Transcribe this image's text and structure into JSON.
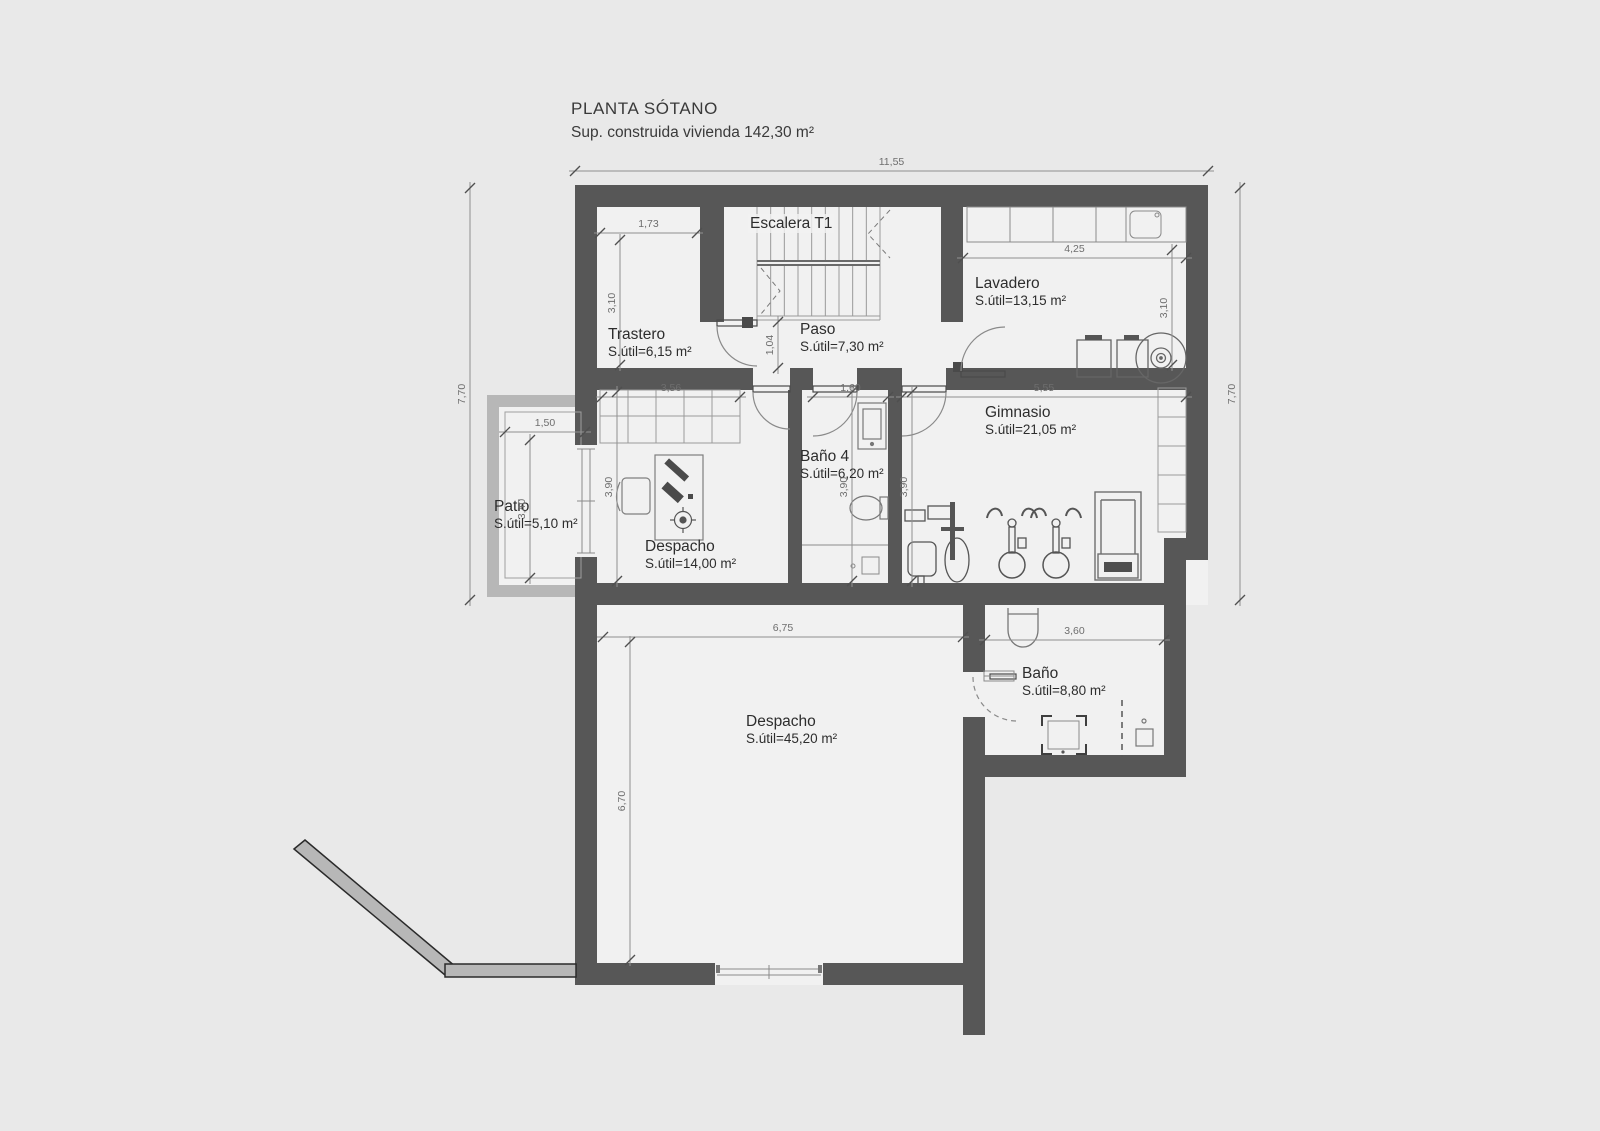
{
  "title": {
    "line1": "PLANTA SÓTANO",
    "line2": "Sup. construida vivienda 142,30 m²"
  },
  "rooms": {
    "escalera": {
      "name": "Escalera T1"
    },
    "trastero": {
      "name": "Trastero",
      "area": "S.útil=6,15 m²"
    },
    "paso": {
      "name": "Paso",
      "area": "S.útil=7,30 m²"
    },
    "lavadero": {
      "name": "Lavadero",
      "area": "S.útil=13,15 m²"
    },
    "despacho_sup": {
      "name": "Despacho",
      "area": "S.útil=14,00 m²"
    },
    "bano4": {
      "name": "Baño 4",
      "area": "S.útil=6,20 m²"
    },
    "gimnasio": {
      "name": "Gimnasio",
      "area": "S.útil=21,05 m²"
    },
    "patio": {
      "name": "Patio",
      "area": "S.útil=5,10 m²"
    },
    "despacho_inf": {
      "name": "Despacho",
      "area": "S.útil=45,20 m²"
    },
    "bano": {
      "name": "Baño",
      "area": "S.útil=8,80 m²"
    }
  },
  "dimensions": {
    "top_width": "11,55",
    "left_height": "7,70",
    "right_height": "7,70",
    "trastero_width": "1,73",
    "trastero_height": "3,10",
    "lavadero_width": "4,25",
    "lavadero_height": "3,10",
    "paso_height": "1,04",
    "wardrobe_width": "3,56",
    "bano4_width": "1,60",
    "gimnasio_width": "5,55",
    "despacho_sup_height": "3,90",
    "bano4_height": "3,90",
    "gimnasio_height": "3,90",
    "patio_width": "1,50",
    "patio_height": "3,40",
    "despacho_inf_width": "6,75",
    "despacho_inf_height": "6,70",
    "bano_width": "3,60"
  },
  "colors": {
    "wall": "#575757",
    "light_wall": "#b7b7b7",
    "background": "#e9e9e9",
    "room_fill": "#f1f1f1",
    "dim_line": "#909090",
    "label_text": "#2d2d2d"
  }
}
